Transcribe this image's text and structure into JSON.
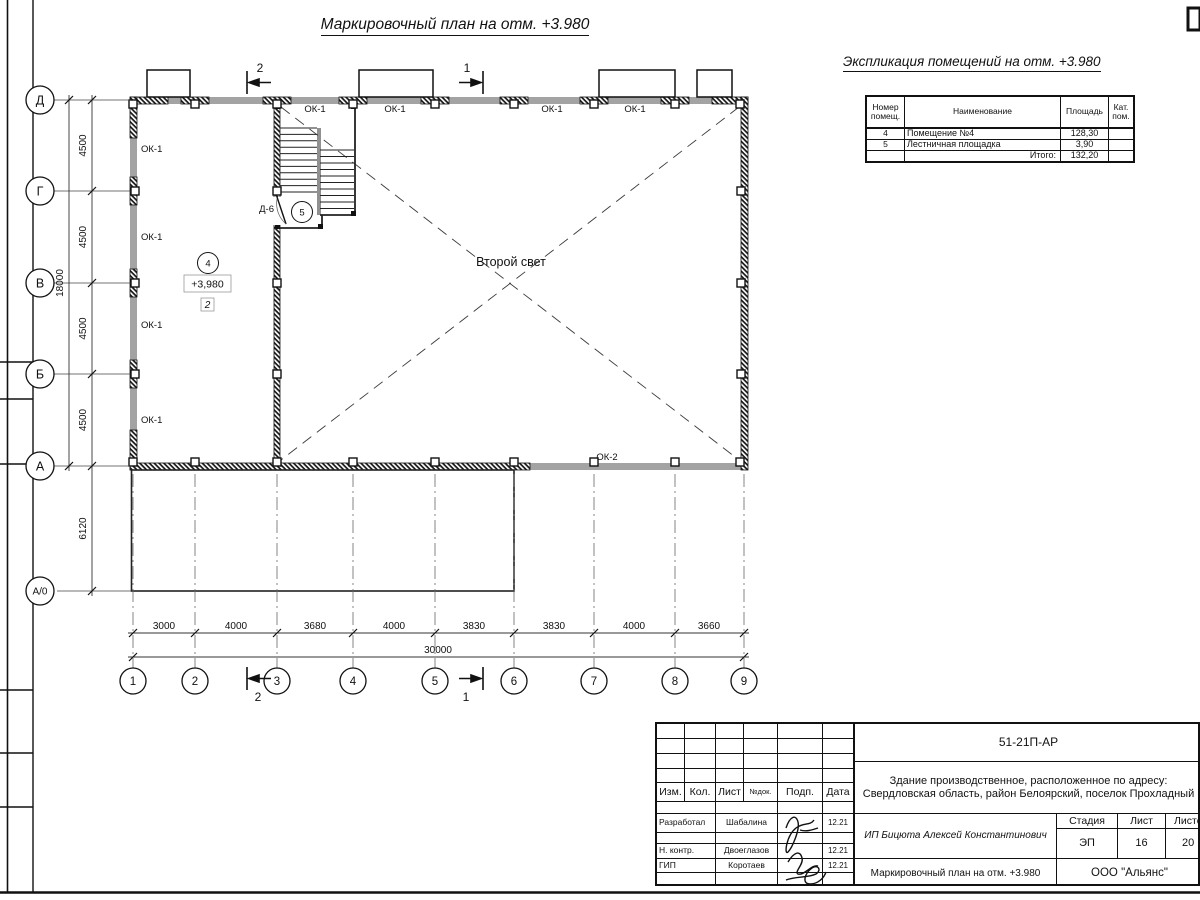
{
  "sheet": {
    "plan_title": "Маркировочный план на отм. +3.980"
  },
  "explication": {
    "title": "Экспликация помещений на отм. +3.980",
    "headers": {
      "num": "Номер\nпомещ.",
      "name": "Наименование",
      "area": "Площадь",
      "cat": "Кат.\nпом."
    },
    "rows": [
      {
        "num": "4",
        "name": "Помещение №4",
        "area": "128,30",
        "cat": ""
      },
      {
        "num": "5",
        "name": "Лестничная площадка",
        "area": "3,90",
        "cat": ""
      }
    ],
    "total_label": "Итого:",
    "total_value": "132,20"
  },
  "plan": {
    "row_axes": [
      "Д",
      "Г",
      "В",
      "Б",
      "А",
      "А/0"
    ],
    "row_dims": [
      "4500",
      "4500",
      "4500",
      "4500"
    ],
    "row_total": "18000",
    "row_lower_dim": "6120",
    "col_axes": [
      "1",
      "2",
      "3",
      "4",
      "5",
      "6",
      "7",
      "8",
      "9"
    ],
    "col_dims": [
      "3000",
      "4000",
      "3680",
      "4000",
      "3830",
      "3830",
      "4000",
      "3660"
    ],
    "col_total": "30000",
    "window_label_1": "ОК-1",
    "window_label_2": "ОК-2",
    "door_label": "Д-6",
    "room4_num": "4",
    "room5_num": "5",
    "elevation_mark": "+3,980",
    "floor_type_mark": "2",
    "void_label": "Второй свет",
    "section_mark_1": "1",
    "section_mark_2": "2"
  },
  "titleblock": {
    "doc_number": "51-21П-АР",
    "object_desc": "Здание производственное, расположенное по адресу:\nСвердловская область, район Белоярский, поселок\nПрохладный",
    "hdr": {
      "izm": "Изм.",
      "kol": "Кол.",
      "list": "Лист",
      "ndoc": "№док.",
      "podp": "Подп.",
      "data": "Дата"
    },
    "roles": [
      {
        "role": "Разработал",
        "name": "Шабалина",
        "date": "12.21"
      },
      {
        "role": "Н. контр.",
        "name": "Двоеглазов",
        "date": "12.21"
      },
      {
        "role": "ГИП",
        "name": "Коротаев",
        "date": "12.21"
      }
    ],
    "customer": "ИП Бицюта Алексей Константинович",
    "stage_label": "Стадия",
    "sheet_label": "Лист",
    "sheets_label": "Листов",
    "stage": "ЭП",
    "sheet_num": "16",
    "sheets_total": "20",
    "drawing_name": "Маркировочный план на отм.\n+3.980",
    "company": "ООО \"Альянс\""
  }
}
